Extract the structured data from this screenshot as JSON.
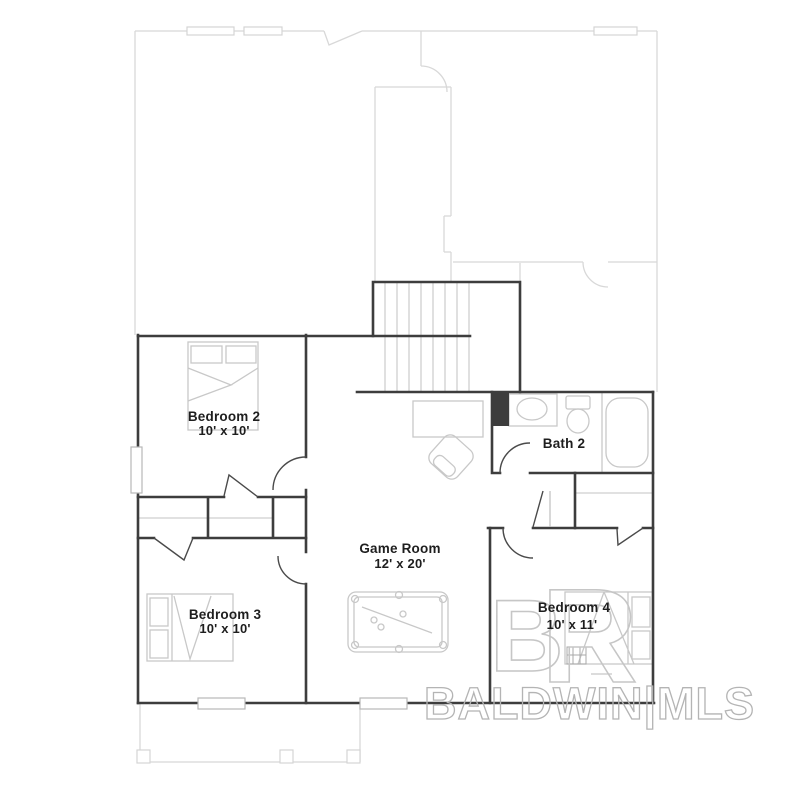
{
  "rooms": {
    "bedroom2": {
      "name": "Bedroom 2",
      "dims": "10' x 10'"
    },
    "bedroom3": {
      "name": "Bedroom 3",
      "dims": "10' x 10'"
    },
    "bedroom4": {
      "name": "Bedroom 4",
      "dims": "10' x 11'"
    },
    "gameroom": {
      "name": "Game Room",
      "dims": "12' x 20'"
    },
    "bath2": {
      "name": "Bath 2"
    }
  },
  "watermark": {
    "mls_text": "BALDWIN|MLS",
    "logo_b": "B",
    "logo_r": "R"
  },
  "colors": {
    "wall": "#3d3d3d",
    "furniture_line": "#c8c8c8",
    "faded_outline": "#d8d8d8",
    "label_text": "#1e1e1e",
    "watermark": "#b4b4b4"
  }
}
